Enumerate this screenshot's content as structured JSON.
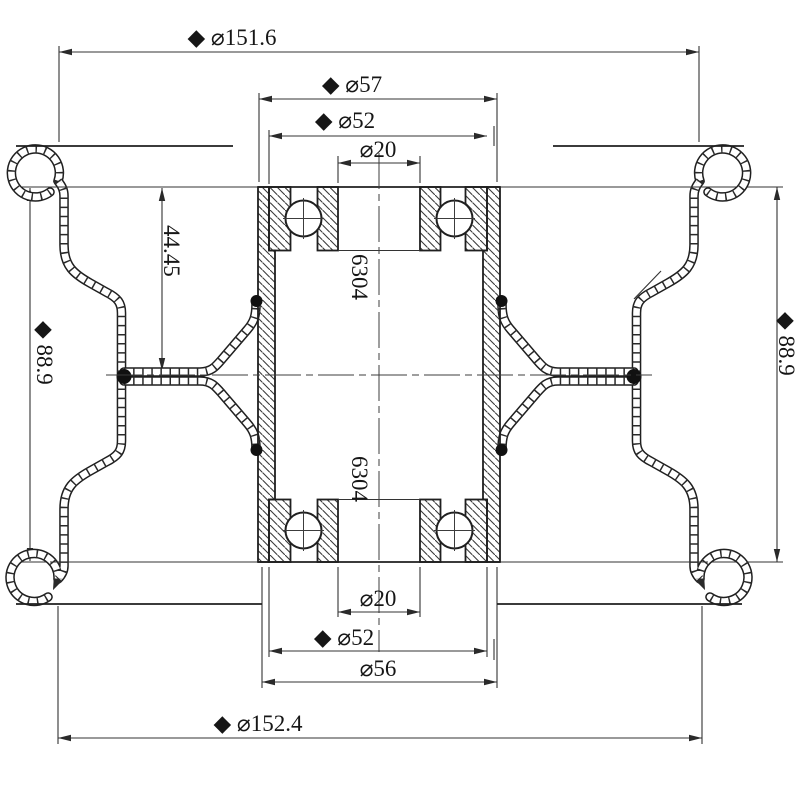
{
  "drawing": {
    "type": "engineering-cross-section",
    "subject": "wheel-rim-and-hub-with-bearings",
    "background_color": "#ffffff",
    "line_color": "#1f1f1f",
    "labels": {
      "dia_151_6": "◆ ⌀151.6",
      "dia_57": "◆ ⌀57",
      "dia_52_top": "◆ ⌀52",
      "dia_20_top": "⌀20",
      "width_44_45": "44.45",
      "width_88_9_left": "◆ 88.9",
      "width_88_9_right": "◆ 88.9",
      "bearing_code_top": "6304",
      "bearing_code_bottom": "6304",
      "dia_20_bottom": "⌀20",
      "dia_52_bottom": "◆ ⌀52",
      "dia_56": "⌀56",
      "dia_152_4": "◆ ⌀152.4"
    }
  }
}
